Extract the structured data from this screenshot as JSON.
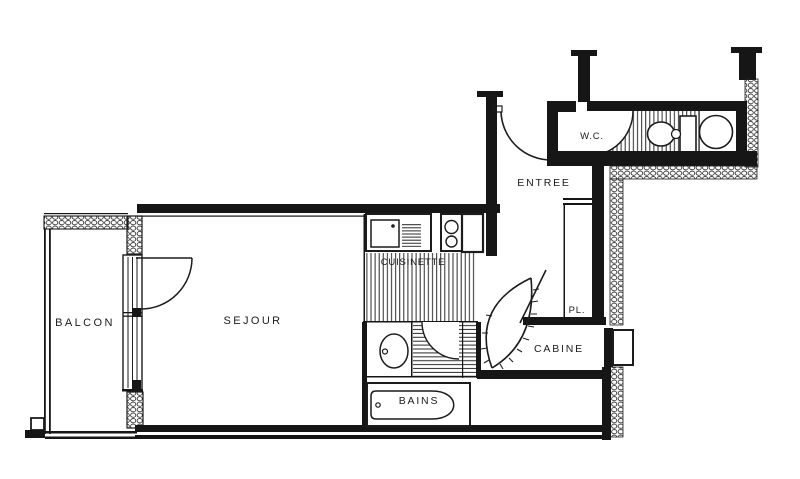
{
  "meta": {
    "document_type": "apartment floor plan (scanned architectural drawing)"
  },
  "colors": {
    "ink": "#1c1c1c",
    "paper": "#ffffff",
    "hatch": "#2f2f2f"
  },
  "rooms": {
    "balcon": {
      "label": "BALCON"
    },
    "sejour": {
      "label": "SEJOUR"
    },
    "cuisinette": {
      "label": "CUISINETTE"
    },
    "bains": {
      "label": "BAINS"
    },
    "cabine": {
      "label": "CABINE"
    },
    "placard": {
      "label": "PL."
    },
    "entree": {
      "label": "ENTREE"
    },
    "wc": {
      "label": "W.C."
    }
  },
  "fixtures": [
    "kitchen-sink",
    "stove-two-burners",
    "cabinet",
    "washbasin",
    "bathtub",
    "toilet",
    "round-washbasin",
    "sliding-bay-window",
    "curved-cabin-door",
    "door-swings",
    "balcony-railing",
    "window",
    "step"
  ]
}
